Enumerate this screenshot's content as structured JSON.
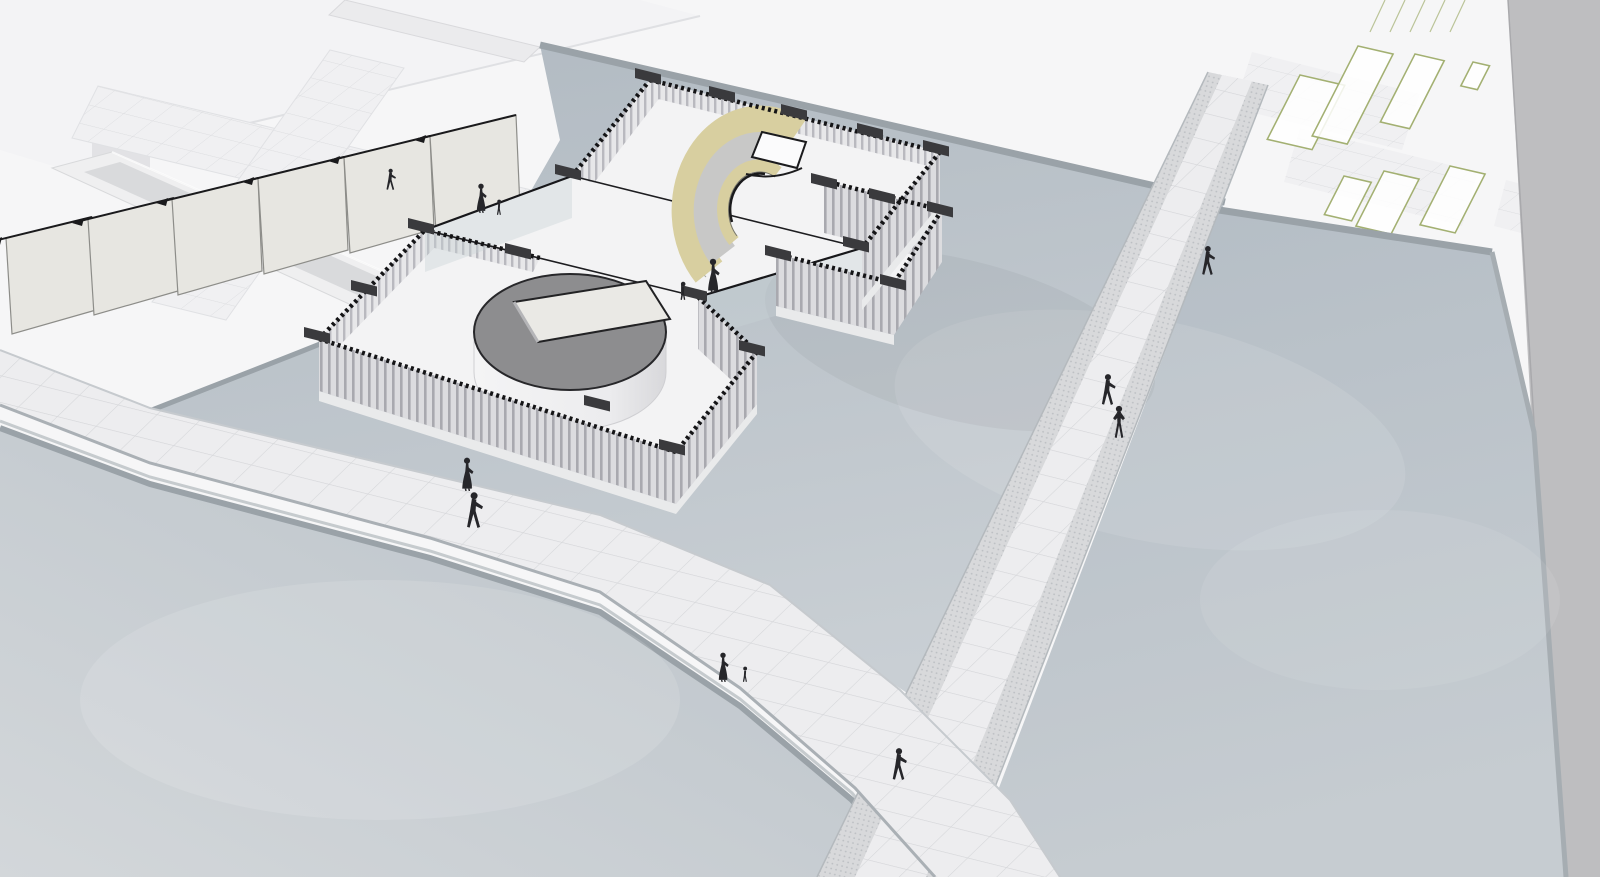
{
  "scene": {
    "title": "Aerial axonometric 3D rendering of a slatted pavilion with crescent ramp, drum hall, reflecting pools, gridded walkways and pedestrian figures",
    "view": "aerial-axonometric",
    "style": "monochrome CAD render with pale yellow ramp accent"
  },
  "colors": {
    "background": "#f6f6f7",
    "roof": "#f3f3f5",
    "roof_edge": "#dfe0e3",
    "panel_fill": "#e7e6e1",
    "panel_stroke": "#8d8d89",
    "pool_rim": "#9aa2a8",
    "pool_rim_light": "#c6cbce",
    "walk_edge_top": "#c6cace",
    "walk_edge_bottom": "#aab0b5",
    "right_band": "#bebec0",
    "floor": "#f3f3f4",
    "trim": "#141416",
    "corner_post": "#3a3a3d",
    "glass": "#c9d1d5",
    "ramp_yellow": "#d8cfa0",
    "ramp_gray": "#c8c8c7",
    "platform": "#fbfbfc",
    "cylinder_top": "#8d8d8f",
    "skylight": "#eae9e5",
    "figure": "#26262a",
    "green": "#a3b072"
  },
  "pavilion": {
    "parts": [
      "top-court",
      "bottom-court",
      "connecting-corridor",
      "crescent-ramp",
      "drum-hall",
      "slatted-walls",
      "corner-posts",
      "glass-corridor-walls"
    ]
  },
  "figures": [
    {
      "kind": "man-walking",
      "x": 390,
      "y": 190,
      "h": 22
    },
    {
      "kind": "woman-dress",
      "x": 481,
      "y": 213,
      "h": 30
    },
    {
      "kind": "child",
      "x": 499,
      "y": 215,
      "h": 16
    },
    {
      "kind": "woman-dress",
      "x": 713,
      "y": 293,
      "h": 35
    },
    {
      "kind": "child",
      "x": 683,
      "y": 300,
      "h": 19
    },
    {
      "kind": "woman-dress",
      "x": 467,
      "y": 491,
      "h": 34
    },
    {
      "kind": "man-walking",
      "x": 473,
      "y": 528,
      "h": 37
    },
    {
      "kind": "woman-dress",
      "x": 723,
      "y": 682,
      "h": 30
    },
    {
      "kind": "child",
      "x": 745,
      "y": 682,
      "h": 16
    },
    {
      "kind": "man-walking",
      "x": 898,
      "y": 780,
      "h": 33
    },
    {
      "kind": "man-walking",
      "x": 1207,
      "y": 275,
      "h": 30
    },
    {
      "kind": "man-walking",
      "x": 1107,
      "y": 405,
      "h": 32
    },
    {
      "kind": "man-akimbo",
      "x": 1119,
      "y": 438,
      "h": 33
    }
  ],
  "corner_posts": [
    [
      648,
      76
    ],
    [
      722,
      94
    ],
    [
      794,
      112
    ],
    [
      870,
      131
    ],
    [
      936,
      148
    ],
    [
      568,
      172
    ],
    [
      856,
      244
    ],
    [
      824,
      181
    ],
    [
      882,
      196
    ],
    [
      940,
      209
    ],
    [
      778,
      253
    ],
    [
      893,
      282
    ],
    [
      421,
      226
    ],
    [
      317,
      335
    ],
    [
      694,
      293
    ],
    [
      752,
      348
    ],
    [
      672,
      447
    ],
    [
      597,
      403
    ],
    [
      364,
      288
    ],
    [
      518,
      251
    ]
  ],
  "green_panels": [
    {
      "x": 1300,
      "y": 75,
      "w": 46,
      "h": 70
    },
    {
      "x": 1358,
      "y": 46,
      "w": 36,
      "h": 98
    },
    {
      "x": 1415,
      "y": 54,
      "w": 30,
      "h": 74
    },
    {
      "x": 1473,
      "y": 62,
      "w": 17,
      "h": 26
    },
    {
      "x": 1344,
      "y": 176,
      "w": 28,
      "h": 42
    },
    {
      "x": 1384,
      "y": 171,
      "w": 36,
      "h": 60
    },
    {
      "x": 1450,
      "y": 166,
      "w": 36,
      "h": 64
    }
  ],
  "tilted_panels": [
    [
      6,
      238
    ],
    [
      88,
      219
    ],
    [
      172,
      199
    ],
    [
      258,
      178
    ],
    [
      344,
      157
    ],
    [
      430,
      136
    ]
  ],
  "green_hatch": {
    "count": 5,
    "x0": 1385,
    "step": 20,
    "dx": -15,
    "dy": 32
  },
  "counts": {
    "figures": 13,
    "pools": 3,
    "walkways": 2,
    "green_panels": 7,
    "tilted_panels": 6
  }
}
